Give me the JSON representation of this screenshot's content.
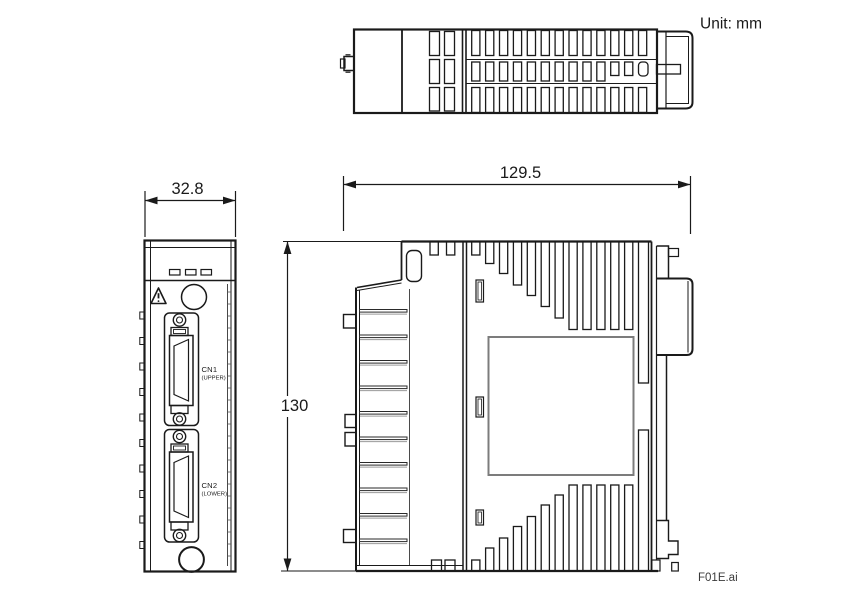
{
  "meta": {
    "unit_label": "Unit: mm",
    "file_label": "F01E.ai"
  },
  "dimensions": {
    "width_mm": "32.8",
    "depth_mm": "129.5",
    "height_mm": "130"
  },
  "front_view": {
    "connectors": [
      {
        "name": "CN1",
        "position_label": "(UPPER)"
      },
      {
        "name": "CN2",
        "position_label": "(LOWER)"
      }
    ],
    "led_count": 3,
    "icons": [
      "warning-triangle-icon"
    ]
  },
  "views": [
    "top-view",
    "front-view",
    "side-view"
  ],
  "colors": {
    "line": "#1a1a1a",
    "secondary_line": "#7c7c7c",
    "background": "#ffffff"
  }
}
